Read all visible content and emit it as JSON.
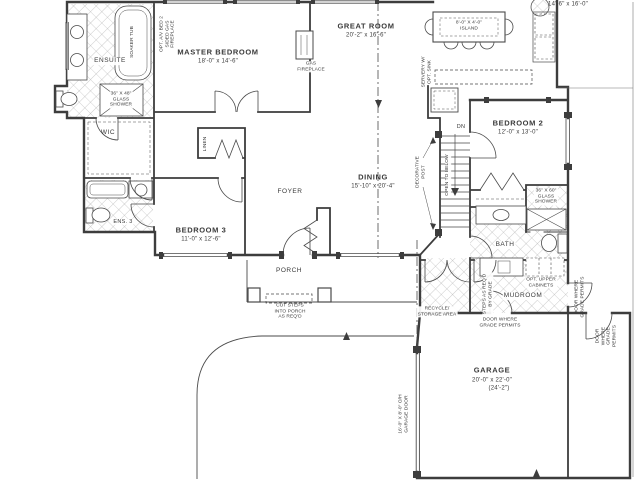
{
  "rooms": {
    "master_bedroom": {
      "name": "MASTER BEDROOM",
      "dims": "18'-0\" x 14'-6\""
    },
    "great_room": {
      "name": "GREAT ROOM",
      "dims": "20'-2\" x 16'-6\""
    },
    "kitchen": {
      "dims": "14'-6\" x 16'-0\""
    },
    "island": {
      "label": "8'-0\" X 4'-0\"\nISLAND"
    },
    "bedroom_2": {
      "name": "BEDROOM 2",
      "dims": "12'-0\" x 13'-0\""
    },
    "bedroom_3": {
      "name": "BEDROOM 3",
      "dims": "11'-0\" x 12'-6\""
    },
    "dining": {
      "name": "DINING",
      "dims": "15'-10\" x 20'-4\""
    },
    "garage": {
      "name": "GARAGE",
      "dims": "20'-0\" x 22'-0\"",
      "dims2": "(24'-2\")"
    },
    "foyer": {
      "name": "FOYER"
    },
    "porch": {
      "name": "PORCH"
    },
    "ensuite": {
      "name": "ENSUITE"
    },
    "wic": {
      "name": "WIC"
    },
    "ens_3": {
      "name": "ENS. 3"
    },
    "linen": {
      "name": "LINEN"
    },
    "bath": {
      "name": "BATH"
    },
    "mudroom": {
      "name": "MUDROOM"
    }
  },
  "annotations": {
    "soaker_tub": "SOAKER TUB",
    "glass_shower_master": "36\" X 48\"\nGLASS\nSHOWER",
    "glass_shower_bath": "36\" X 60\"\nGLASS\nSHOWER",
    "opt_fireplace": "OPT. A/V BED 2\nSIDED GAS\nFIREPLACE",
    "gas_fireplace": "GAS\nFIREPLACE",
    "servery": "SERVERY W/\nOPT. SINK",
    "dn": "DN",
    "open_to_below": "OPEN TO BELOW",
    "decorative_post": "DECORATIVE\nPOST",
    "cut_steps": "CUT STEPS\nINTO PORCH\nAS REQ'D",
    "opt_upper_cabinets": "OPT. UPPER\nCABINETS",
    "steps_by_grade": "STEPS AS REQ'D\nBY GRADE",
    "door_grade_1": "DOOR WHERE\nGRADE PERMITS",
    "door_grade_2": "DOOR WHERE\nGRADE PERMITS",
    "door_grade_3": "DOOR WHERE\nGRADE PERMITS",
    "recycle": "RECYCLE/\nSTORAGE AREA",
    "garage_door": "16'-0\" X 8'-0\" O/H\nGARAGE DOOR"
  },
  "colors": {
    "ink": "#3d3d3d",
    "paper": "#ffffff",
    "tile": "#a8a8a8"
  }
}
